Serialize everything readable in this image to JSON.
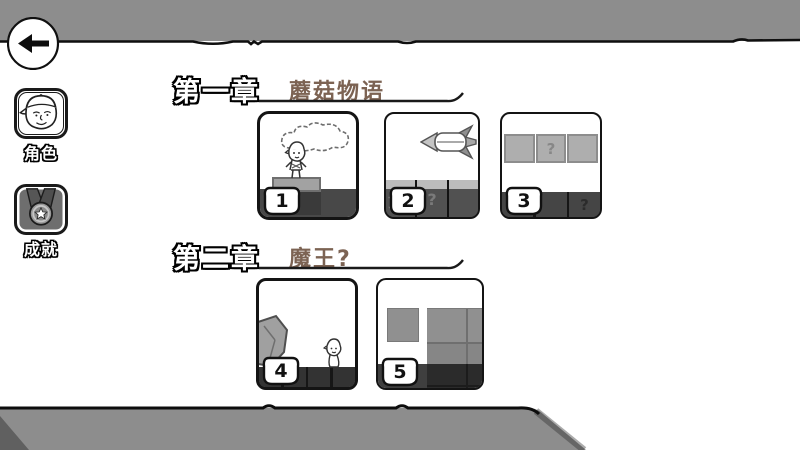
{
  "colors": {
    "bar_gray": "#8d8d8d",
    "accent_brown": "#7c6353",
    "ground_dark": "#454545",
    "block_light": "#aeaeae"
  },
  "back_button": {
    "icon": "arrow-left"
  },
  "sidebar": {
    "items": [
      {
        "id": "character",
        "label": "角色",
        "icon": "character-avatar"
      },
      {
        "id": "achievements",
        "label": "成就",
        "icon": "medal-star"
      }
    ]
  },
  "chapters": [
    {
      "heading": "第一章",
      "title": "蘑菇物语",
      "levels": [
        {
          "number": "1",
          "scene": "character-on-pedestal-under-cloud"
        },
        {
          "number": "2",
          "scene": "rocket-over-blocks",
          "block_label": "顶我",
          "question": "?"
        },
        {
          "number": "3",
          "scene": "floating-blocks",
          "question_block": "?",
          "question_ground": "?"
        }
      ]
    },
    {
      "heading": "第二章",
      "title": "魔王?",
      "levels": [
        {
          "number": "4",
          "scene": "boulder-and-character"
        },
        {
          "number": "5",
          "scene": "stacked-gray-blocks"
        }
      ]
    }
  ]
}
